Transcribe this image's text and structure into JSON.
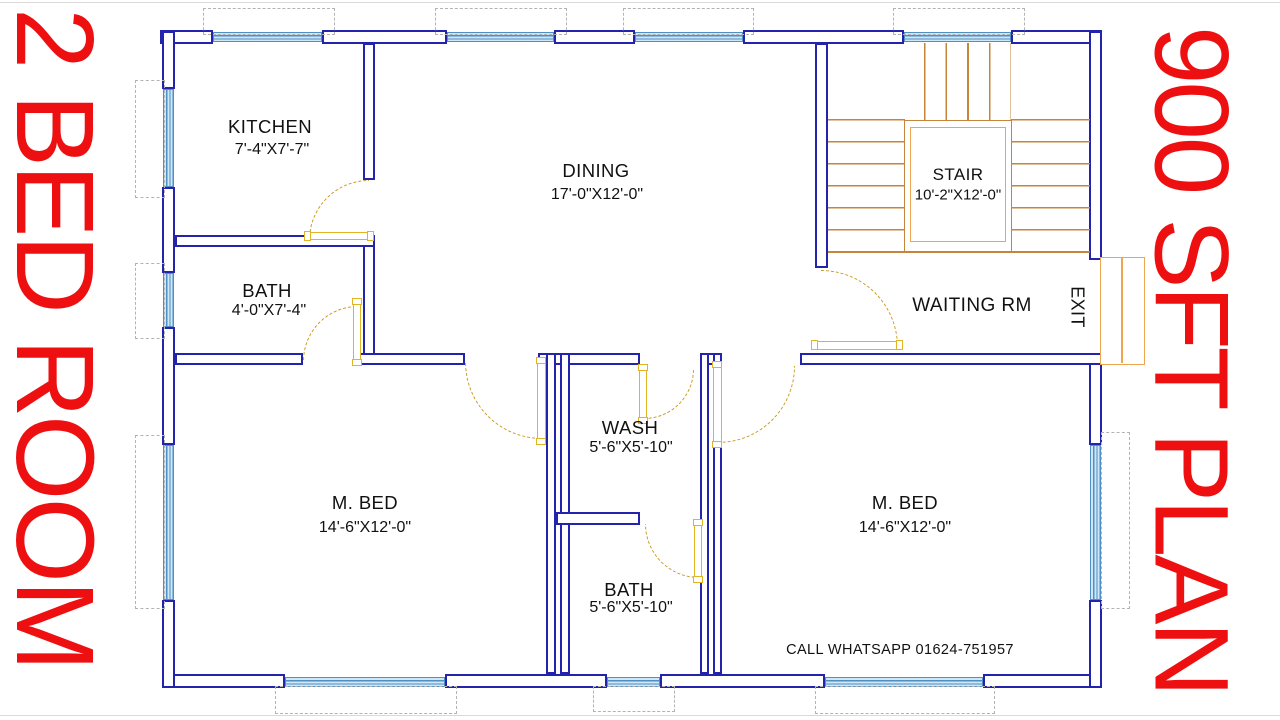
{
  "side_banners": {
    "left": "2 BED ROOM",
    "right": "900 SFT PLAN"
  },
  "rooms": {
    "kitchen": {
      "name": "KITCHEN",
      "dims": "7'-4\"X7'-7\""
    },
    "dining": {
      "name": "DINING",
      "dims": "17'-0\"X12'-0\""
    },
    "stair": {
      "name": "STAIR",
      "dims": "10'-2\"X12'-0\""
    },
    "bath_top": {
      "name": "BATH",
      "dims": "4'-0\"X7'-4\""
    },
    "waiting": {
      "name": "WAITING RM"
    },
    "exit": {
      "name": "EXIT"
    },
    "master_bed_left": {
      "name": "M. BED",
      "dims": "14'-6\"X12'-0\""
    },
    "wash": {
      "name": "WASH",
      "dims": "5'-6\"X5'-10\""
    },
    "bath_bottom": {
      "name": "BATH",
      "dims": "5'-6\"X5'-10\""
    },
    "master_bed_right": {
      "name": "M. BED",
      "dims": "14'-6\"X12'-0\""
    }
  },
  "contact": {
    "text": "CALL WHATSAPP 01624-751957"
  },
  "colors": {
    "wall": "#2323ac",
    "winline": "#4e8fc4",
    "winbg": "#cfe7f6",
    "stair": "#c6853b",
    "landing": "#eda54e",
    "door": "#e3b422",
    "arc": "#cb9a1f",
    "banner": "#ee1011",
    "dash": "#b3b3b3",
    "ink": "#111111"
  }
}
